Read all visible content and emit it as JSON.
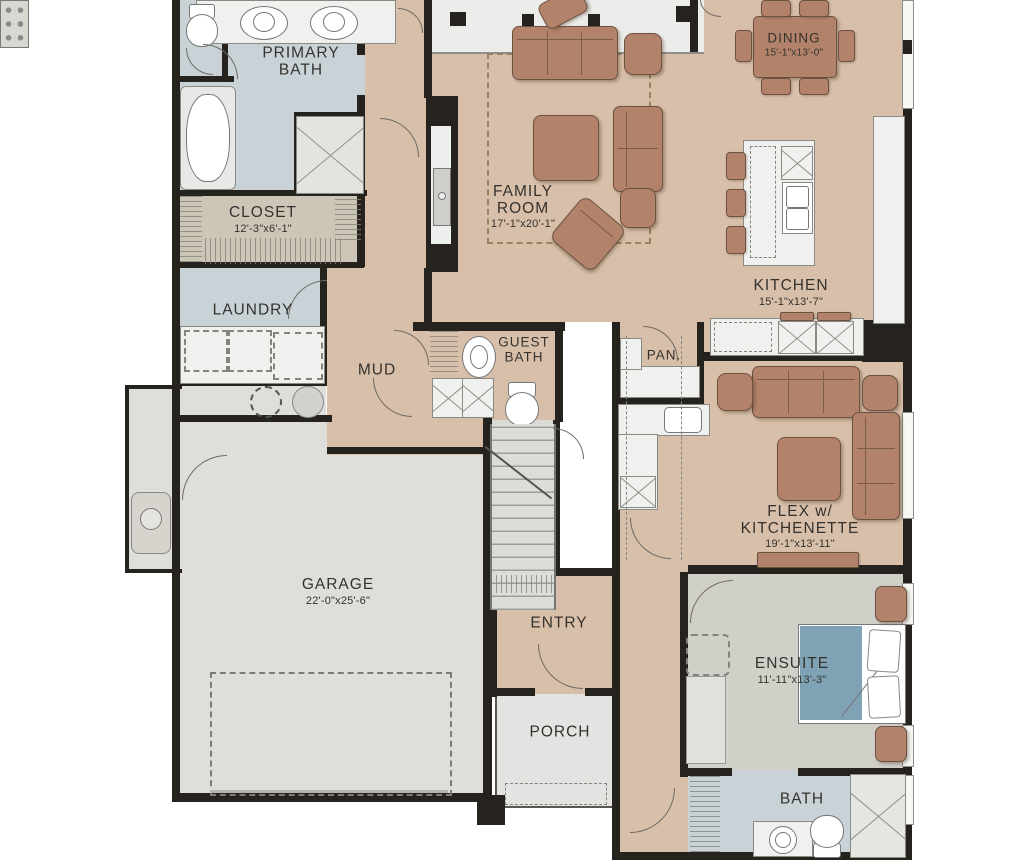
{
  "palette": {
    "floor_tan": "#d8bfa9",
    "floor_blue": "#c9d2d6",
    "floor_gray": "#dededb",
    "floor_closet": "#cdc6b7",
    "floor_ensuite": "#d0cfc8",
    "wall": "#26231f",
    "furniture_brown": "#b2826a",
    "bed_blue": "#7fa2b4",
    "counter_white": "#f0f0ee"
  },
  "rooms": {
    "primary_bath": {
      "name": "PRIMARY\nBATH"
    },
    "closet": {
      "name": "CLOSET",
      "dims": "12'-3\"x6'-1\""
    },
    "laundry": {
      "name": "LAUNDRY"
    },
    "mud": {
      "name": "MUD"
    },
    "guest_bath": {
      "name": "GUEST\nBATH"
    },
    "family_room": {
      "name": "FAMILY\nROOM",
      "dims": "17'-1\"x20'-1\""
    },
    "dining": {
      "name": "DINING",
      "dims": "15'-1\"x13'-0\""
    },
    "kitchen": {
      "name": "KITCHEN",
      "dims": "15'-1\"x13'-7\""
    },
    "pantry": {
      "name": "PAN."
    },
    "flex": {
      "name": "FLEX w/\nKITCHENETTE",
      "dims": "19'-1\"x13'-11\""
    },
    "garage": {
      "name": "GARAGE",
      "dims": "22'-0\"x25'-6\""
    },
    "entry": {
      "name": "ENTRY"
    },
    "porch": {
      "name": "PORCH"
    },
    "ensuite": {
      "name": "ENSUITE",
      "dims": "11'-11\"x13'-3\""
    },
    "bath": {
      "name": "BATH"
    }
  }
}
